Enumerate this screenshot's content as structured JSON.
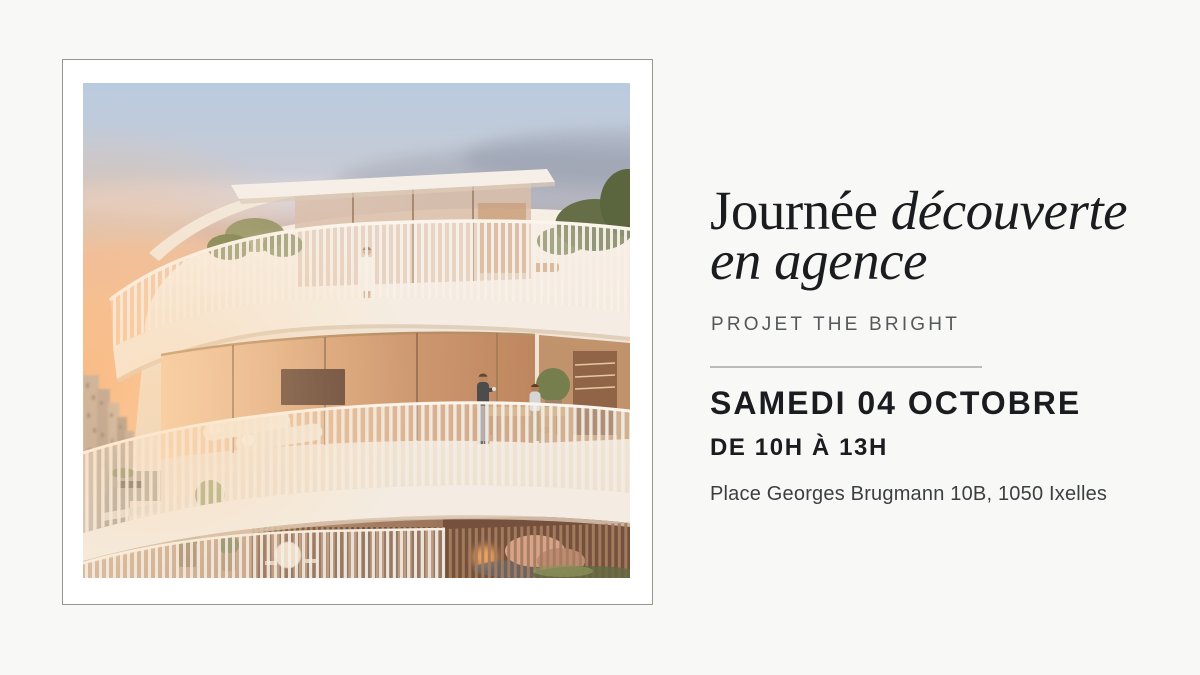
{
  "palette": {
    "page-bg": "#f8f8f6",
    "card-bg": "#ffffff",
    "card-border": "#96968f",
    "ink": "#1b1c1f",
    "muted": "#55585b",
    "body": "#3c3f42",
    "divider": "#bcbcbc"
  },
  "photo": {
    "alt": "Sunset architectural rendering of the project: a curved apartment building with white vertical-slat terrace railings, a rooftop glass pavilion, plants and residents on the terraces, above a city street on the left"
  },
  "details": {
    "title": {
      "roman": "Journée",
      "italic": "découverte",
      "line2": "en agence"
    },
    "project_label": "PROJET THE BRIGHT",
    "date": "SAMEDI 04 OCTOBRE",
    "time": "DE 10H À 13H",
    "address": "Place Georges Brugmann 10B, 1050 Ixelles"
  }
}
